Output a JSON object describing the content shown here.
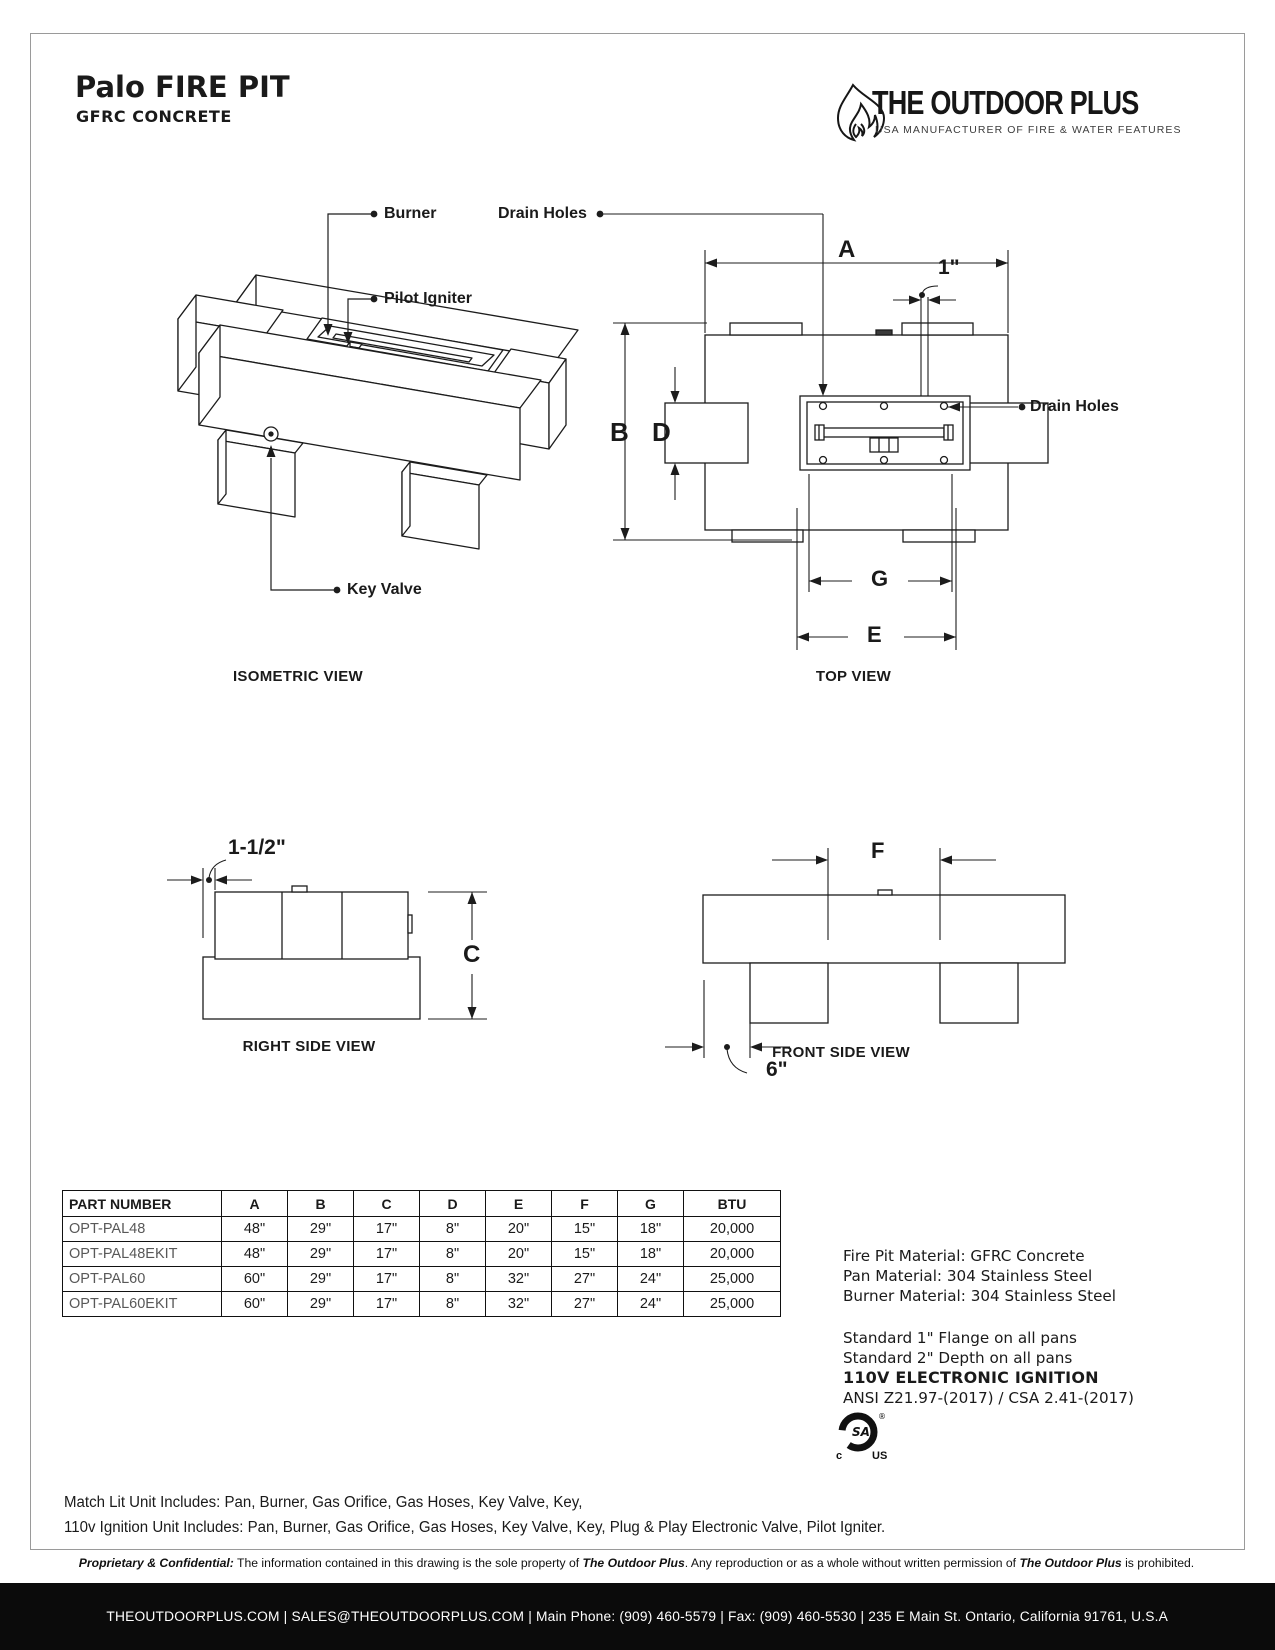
{
  "header": {
    "title": "Palo FIRE PIT",
    "subtitle": "GFRC CONCRETE",
    "brand": {
      "name": "THE OUTDOOR PLUS",
      "tagline": "USA MANUFACTURER OF FIRE & WATER FEATURES"
    }
  },
  "drawing": {
    "callouts": {
      "burner": "Burner",
      "pilot_igniter": "Pilot Igniter",
      "key_valve": "Key Valve",
      "drain_holes_top": "Drain Holes",
      "drain_holes_right": "Drain Holes"
    },
    "dims": {
      "a": "A",
      "b": "B",
      "c": "C",
      "d": "D",
      "e": "E",
      "f": "F",
      "g": "G",
      "one_inch": "1\"",
      "one_and_half_inch": "1-1/2\"",
      "six_inch": "6\""
    },
    "view_labels": {
      "isometric": "ISOMETRIC VIEW",
      "top": "TOP VIEW",
      "right": "RIGHT SIDE VIEW",
      "front": "FRONT SIDE VIEW"
    }
  },
  "table": {
    "headers": [
      "PART NUMBER",
      "A",
      "B",
      "C",
      "D",
      "E",
      "F",
      "G",
      "BTU"
    ],
    "rows": [
      [
        "OPT-PAL48",
        "48\"",
        "29\"",
        "17\"",
        "8\"",
        "20\"",
        "15\"",
        "18\"",
        "20,000"
      ],
      [
        "OPT-PAL48EKIT",
        "48\"",
        "29\"",
        "17\"",
        "8\"",
        "20\"",
        "15\"",
        "18\"",
        "20,000"
      ],
      [
        "OPT-PAL60",
        "60\"",
        "29\"",
        "17\"",
        "8\"",
        "32\"",
        "27\"",
        "24\"",
        "25,000"
      ],
      [
        "OPT-PAL60EKIT",
        "60\"",
        "29\"",
        "17\"",
        "8\"",
        "32\"",
        "27\"",
        "24\"",
        "25,000"
      ]
    ]
  },
  "specs": {
    "materials": [
      "Fire Pit Material: GFRC Concrete",
      "Pan Material: 304 Stainless Steel",
      "Burner Material: 304 Stainless Steel"
    ],
    "standards": [
      "Standard 1\" Flange on all pans",
      "Standard 2\" Depth on all pans"
    ],
    "ignition": "110V ELECTRONIC IGNITION",
    "certification": "ANSI Z21.97-(2017) / CSA 2.41-(2017)",
    "csa_mark": "SA",
    "csa_reg": "®",
    "csa_c": "c",
    "csa_us": "US"
  },
  "notes": [
    "Match Lit Unit Includes: Pan, Burner, Gas Orifice, Gas Hoses, Key Valve, Key,",
    "110v Ignition Unit Includes: Pan, Burner, Gas Orifice, Gas Hoses, Key Valve, Key, Plug & Play Electronic Valve, Pilot Igniter."
  ],
  "footer": {
    "proprietary": {
      "p1": "Proprietary & Confidential:",
      "p2": " The information contained in this drawing is the sole property of ",
      "p3": "The Outdoor Plus",
      "p4": ". Any reproduction or as a whole without written permission of ",
      "p5": "The Outdoor Plus",
      "p6": " is prohibited."
    },
    "contact": "THEOUTDOORPLUS.COM   |   SALES@THEOUTDOORPLUS.COM   |  Main Phone: (909) 460-5579  |  Fax: (909) 460-5530  |  235 E Main St. Ontario, California 91761, U.S.A"
  }
}
